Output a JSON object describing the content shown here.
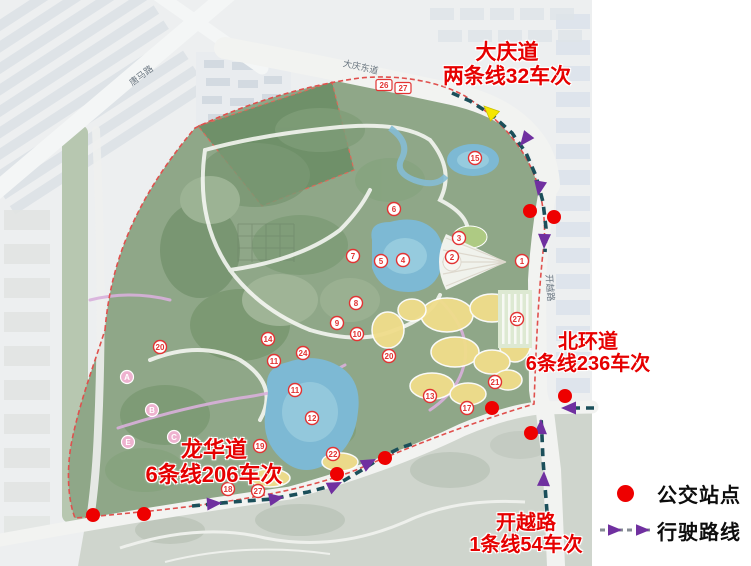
{
  "annotations": [
    {
      "id": "daqing",
      "line1": "大庆道",
      "line2": "两条线32车次"
    },
    {
      "id": "beihuan",
      "line1": "北环道",
      "line2": "6条线236车次"
    },
    {
      "id": "longhua",
      "line1": "龙华道",
      "line2": "6条线206车次"
    },
    {
      "id": "kaiyue",
      "line1": "开越路",
      "line2": "1条线54车次"
    }
  ],
  "legend": {
    "items": [
      {
        "symbol": "bus-stop-dot",
        "label": "公交站点"
      },
      {
        "symbol": "route-arrow",
        "label": "行驶路线"
      }
    ]
  },
  "colors": {
    "annotation_red": "#e60000",
    "bus_stop_red": "#ee0000",
    "route_dash_teal": "#1b4f5a",
    "arrow_purple": "#7030a0",
    "start_arrow_yellow": "#f5e600",
    "legend_dash_gray": "#868d94"
  },
  "map": {
    "road_labels": [
      {
        "text": "唐马路",
        "x": 143,
        "y": 78,
        "rotate": -37
      },
      {
        "text": "大庆东道",
        "x": 360,
        "y": 70,
        "rotate": 13
      },
      {
        "text": "开越路",
        "x": 547,
        "y": 288,
        "rotate": 86
      }
    ],
    "bus_stops": [
      {
        "x": 530,
        "y": 211
      },
      {
        "x": 554,
        "y": 217
      },
      {
        "x": 565,
        "y": 396
      },
      {
        "x": 492,
        "y": 408
      },
      {
        "x": 531,
        "y": 433
      },
      {
        "x": 385,
        "y": 458
      },
      {
        "x": 337,
        "y": 474
      },
      {
        "x": 144,
        "y": 514
      },
      {
        "x": 93,
        "y": 515
      }
    ],
    "routes": [
      {
        "name": "daqing-to-kaiyue-southbound",
        "points": [
          [
            452,
            93
          ],
          [
            470,
            101
          ],
          [
            492,
            115
          ],
          [
            512,
            133
          ],
          [
            526,
            153
          ],
          [
            536,
            176
          ],
          [
            543,
            202
          ],
          [
            546,
            228
          ],
          [
            545,
            252
          ]
        ],
        "arrows": [
          [
            520,
            146,
            128
          ],
          [
            538,
            196,
            100
          ],
          [
            544,
            249,
            92
          ]
        ]
      },
      {
        "name": "kaiyue-northbound",
        "points": [
          [
            547,
            512
          ],
          [
            545,
            486
          ],
          [
            543,
            460
          ],
          [
            542,
            436
          ],
          [
            541,
            416
          ]
        ],
        "arrows": [
          [
            544,
            471,
            -88
          ],
          [
            541,
            419,
            -88
          ]
        ]
      },
      {
        "name": "beihuan-westbound",
        "points": [
          [
            594,
            408
          ],
          [
            571,
            408
          ]
        ],
        "arrows": [
          [
            561,
            408,
            180
          ]
        ]
      },
      {
        "name": "longhua-eastbound",
        "points": [
          [
            192,
            506
          ],
          [
            232,
            502
          ],
          [
            272,
            499
          ],
          [
            308,
            492
          ],
          [
            338,
            484
          ],
          [
            362,
            470
          ],
          [
            382,
            457
          ],
          [
            400,
            448
          ],
          [
            412,
            444
          ]
        ],
        "arrows": [
          [
            222,
            503,
            -4
          ],
          [
            284,
            497,
            -10
          ],
          [
            342,
            482,
            -26
          ],
          [
            376,
            459,
            -28
          ]
        ]
      }
    ],
    "special_arrows": [
      {
        "name": "route-start-arrow",
        "x": 484,
        "y": 106,
        "angle": -137,
        "color": "#f5e600"
      }
    ],
    "markers": [
      {
        "n": "26",
        "x": 384,
        "y": 85,
        "t": "b"
      },
      {
        "n": "27",
        "x": 403,
        "y": 88,
        "t": "b"
      },
      {
        "n": "15",
        "x": 475,
        "y": 158,
        "t": "c"
      },
      {
        "n": "6",
        "x": 394,
        "y": 209,
        "t": "c"
      },
      {
        "n": "3",
        "x": 459,
        "y": 238,
        "t": "c"
      },
      {
        "n": "2",
        "x": 452,
        "y": 257,
        "t": "c"
      },
      {
        "n": "1",
        "x": 522,
        "y": 261,
        "t": "c"
      },
      {
        "n": "4",
        "x": 403,
        "y": 260,
        "t": "c"
      },
      {
        "n": "5",
        "x": 381,
        "y": 261,
        "t": "c"
      },
      {
        "n": "7",
        "x": 353,
        "y": 256,
        "t": "c"
      },
      {
        "n": "8",
        "x": 356,
        "y": 303,
        "t": "c"
      },
      {
        "n": "9",
        "x": 337,
        "y": 323,
        "t": "c"
      },
      {
        "n": "10",
        "x": 357,
        "y": 334,
        "t": "c"
      },
      {
        "n": "14",
        "x": 268,
        "y": 339,
        "t": "c"
      },
      {
        "n": "24",
        "x": 303,
        "y": 353,
        "t": "c"
      },
      {
        "n": "11",
        "x": 274,
        "y": 361,
        "t": "c"
      },
      {
        "n": "11",
        "x": 295,
        "y": 390,
        "t": "c"
      },
      {
        "n": "20",
        "x": 160,
        "y": 347,
        "t": "c"
      },
      {
        "n": "20",
        "x": 389,
        "y": 356,
        "t": "c"
      },
      {
        "n": "12",
        "x": 312,
        "y": 418,
        "t": "c"
      },
      {
        "n": "22",
        "x": 333,
        "y": 454,
        "t": "c"
      },
      {
        "n": "19",
        "x": 260,
        "y": 446,
        "t": "c"
      },
      {
        "n": "13",
        "x": 430,
        "y": 396,
        "t": "c"
      },
      {
        "n": "18",
        "x": 228,
        "y": 489,
        "t": "c"
      },
      {
        "n": "27",
        "x": 258,
        "y": 491,
        "t": "c"
      },
      {
        "n": "21",
        "x": 495,
        "y": 382,
        "t": "c"
      },
      {
        "n": "27",
        "x": 517,
        "y": 319,
        "t": "c"
      },
      {
        "n": "17",
        "x": 467,
        "y": 408,
        "t": "c"
      },
      {
        "n": "A",
        "x": 127,
        "y": 377,
        "t": "l"
      },
      {
        "n": "B",
        "x": 152,
        "y": 410,
        "t": "l"
      },
      {
        "n": "C",
        "x": 174,
        "y": 437,
        "t": "l"
      },
      {
        "n": "E",
        "x": 128,
        "y": 442,
        "t": "l"
      }
    ]
  }
}
